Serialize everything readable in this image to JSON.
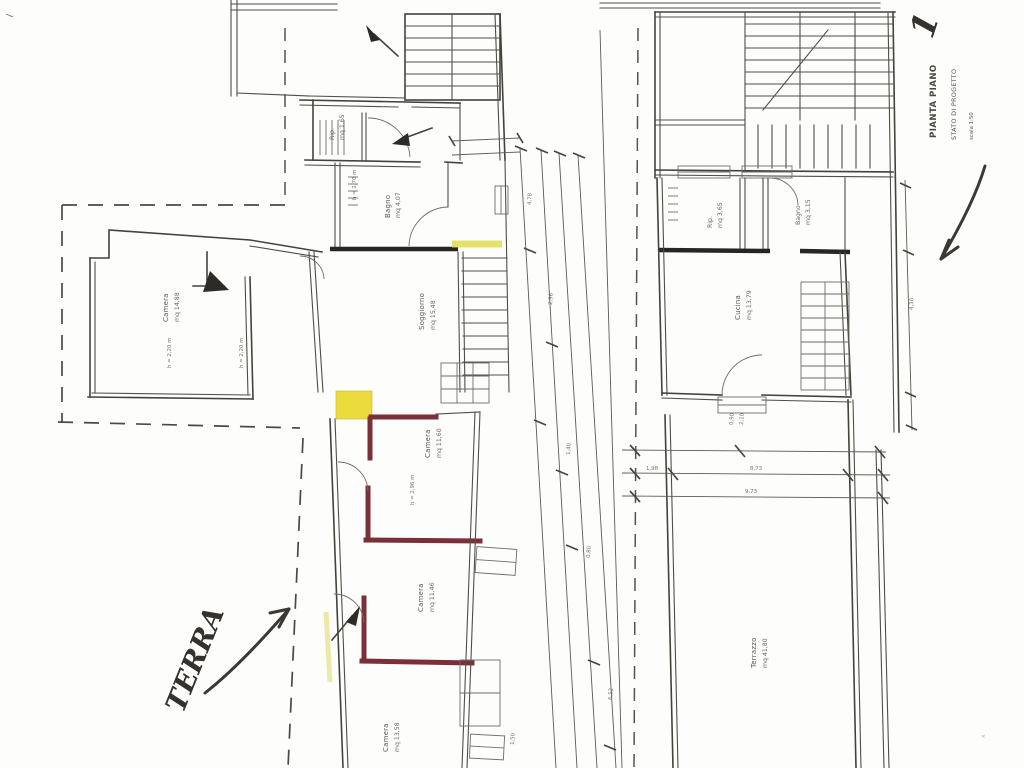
{
  "sheet": {
    "sheet_number": "1",
    "plan_title_main": "PIANTA PIANO",
    "plan_title_sub": "STATO DI PROGETTO",
    "plan_title_scale": "scala 1:50",
    "floor_note_handwritten": "TERRA",
    "footer_line1": "PIANO",
    "footer_line2": "PROGETTO"
  },
  "colors": {
    "ink": "#4f4c47",
    "wall_dark": "#26231e",
    "new_wall_maroon": "#7b2d36",
    "highlight_yellow": "#eedd3a",
    "highlight_pale": "#e4e050"
  },
  "left_plan": {
    "rooms": [
      {
        "name": "Camera",
        "area": "mq 14,88"
      },
      {
        "name": "Rip.",
        "area": "mq 1,65"
      },
      {
        "name": "Bagno",
        "area": "mq 4,07"
      },
      {
        "name": "Soggiorno",
        "area": "mq 15,48"
      },
      {
        "name": "Camera",
        "area": "mq 11,60"
      },
      {
        "name": "Camera",
        "area": "mq 11,46"
      },
      {
        "name": "Camera",
        "area": "mq 13,58"
      }
    ],
    "heights": [
      {
        "text": "h = 2,20 m"
      },
      {
        "text": "h = 2,20 m"
      },
      {
        "text": "h = 2,70 m"
      },
      {
        "text": "h = 2,96 m"
      }
    ]
  },
  "right_plan": {
    "rooms": [
      {
        "name": "Rip.",
        "area": "mq 3,65"
      },
      {
        "name": "Bagno",
        "area": "mq 3,15"
      },
      {
        "name": "Cucina",
        "area": "mq 13,79"
      },
      {
        "name": "Terrazzo",
        "area": "mq 41,80"
      }
    ]
  },
  "dims": {
    "a": "4,78",
    "b": "2,96",
    "c": "1,40",
    "d": "0,80",
    "e": "6,52",
    "f": "8,73",
    "g": "9,73",
    "h": "1,98",
    "i": "4,30",
    "j": "0,90",
    "k": "2,10",
    "l": "1,50"
  }
}
